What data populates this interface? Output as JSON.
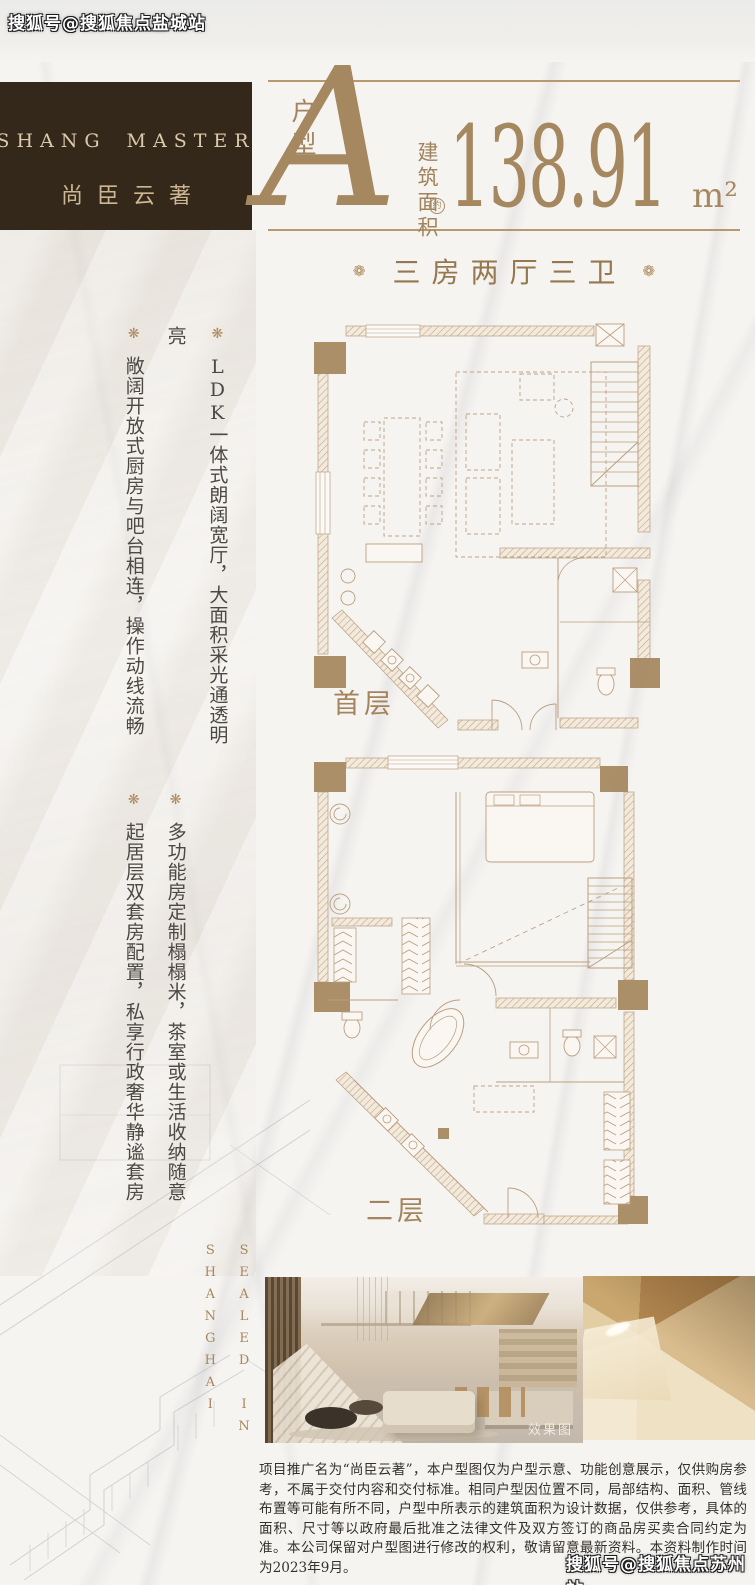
{
  "watermarks": {
    "top_left": "搜狐号@搜狐焦点盐城站",
    "bottom_right": "搜狐号@搜狐焦点苏州站"
  },
  "brand": {
    "name_left": "SHANG",
    "name_right": "MASTER",
    "name_cn": "尚臣云著"
  },
  "unit": {
    "type_label": "户型",
    "type_letter": "A",
    "area_label": "建筑面积",
    "area_approx": "约",
    "area_value": "138.91",
    "area_unit": "m²",
    "layout": "三房两厅三卫",
    "layout_ornament": "❁"
  },
  "features": {
    "ornament": "❋",
    "items": [
      "LDK一体式朗阔宽厅，大面积采光通透明亮",
      "敞阔开放式厨房与吧台相连，操作动线流畅",
      "多功能房定制榻榻米，茶室或生活收纳随意",
      "起居层双套房配置，私享行政奢华静谧套房"
    ]
  },
  "floor_plans": {
    "first_label": "首层",
    "second_label": "二层"
  },
  "side_caption": {
    "line1": "SEALED IN",
    "line2": "SHANGHAI"
  },
  "photos": {
    "render_caption": "效果图"
  },
  "disclaimer": "项目推广名为“尚臣云著”，本户型图仅为户型示意、功能创意展示，仅供购房参考，不属于交付内容和交付标准。相同户型因位置不同，局部结构、面积、管线布置等可能有所不同，户型中所表示的建筑面积为设计数据，仅供参考，具体的面积、尺寸等以政府最后批准之法律文件及双方签订的商品房买卖合同约定为准。本公司保留对户型图进行修改的权利，敬请留意最新资料。本资料制作时间为2023年9月。",
  "colors": {
    "accent_gold": "#a5885f",
    "plan_line": "#b89b7c",
    "header_bg": "#33281a",
    "ink": "#34312c"
  }
}
